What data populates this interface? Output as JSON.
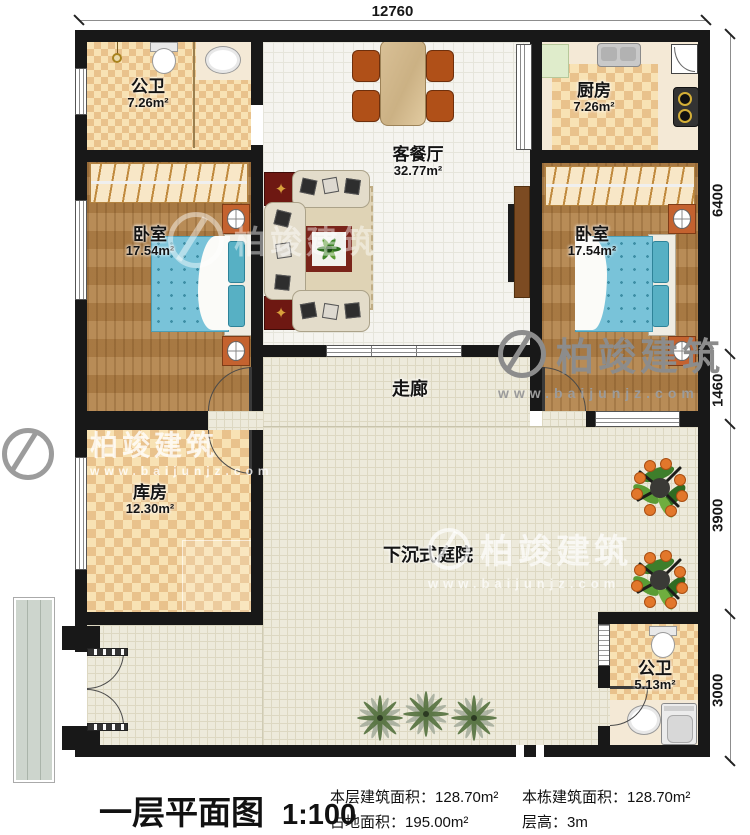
{
  "dimensions": {
    "top": "12760",
    "right": [
      "6400",
      "1460",
      "3900",
      "3000"
    ]
  },
  "rooms": {
    "bath_top": {
      "name": "公卫",
      "area": "7.26m²"
    },
    "kitchen": {
      "name": "厨房",
      "area": "7.26m²"
    },
    "living_dining": {
      "name": "客餐厅",
      "area": "32.77m²"
    },
    "bedroom_left": {
      "name": "卧室",
      "area": "17.54m²"
    },
    "bedroom_right": {
      "name": "卧室",
      "area": "17.54m²"
    },
    "corridor": {
      "name": "走廊"
    },
    "storage": {
      "name": "库房",
      "area": "12.30m²"
    },
    "courtyard": {
      "name": "下沉式庭院"
    },
    "bath_bottom": {
      "name": "公卫",
      "area": "5.13m²"
    }
  },
  "watermark": {
    "brand": "柏竣建筑",
    "url": "www.baijunjz.com"
  },
  "title_block": {
    "title": "一层平面图",
    "scale": "1:100",
    "stats": [
      {
        "label": "本层建筑面积：",
        "value": "128.70m²"
      },
      {
        "label": "占地面积：",
        "value": "195.00m²"
      },
      {
        "label": "本栋建筑面积：",
        "value": "128.70m²"
      },
      {
        "label": "层高：",
        "value": "3m"
      }
    ]
  },
  "colors": {
    "wall": "#181818",
    "accent_red": "#6e1812",
    "bed_blue": "#79c3d9"
  }
}
